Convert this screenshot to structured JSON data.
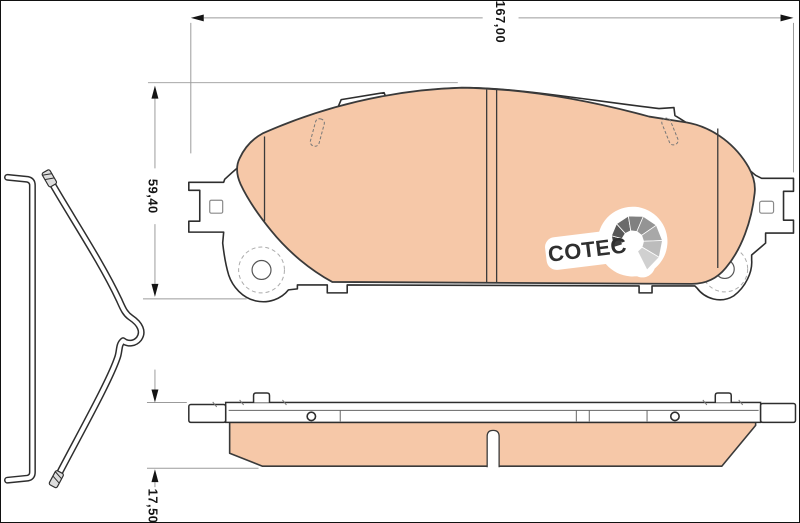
{
  "labels": {
    "width": "167,00",
    "height": "59,40",
    "thickness": "17,50"
  },
  "logo": {
    "text": "COTEC"
  },
  "colors": {
    "friction": "#f6c8a8",
    "outline": "#2e2e2e",
    "dimension_line": "#9b9b9b",
    "label_text": "#141414",
    "logo_text": "#2f2f2f",
    "fan": [
      "#3f3f3f",
      "#575757",
      "#6b6b6b",
      "#808080",
      "#949494",
      "#a8a8a8",
      "#bcbcbc",
      "#d0d0d0"
    ]
  }
}
